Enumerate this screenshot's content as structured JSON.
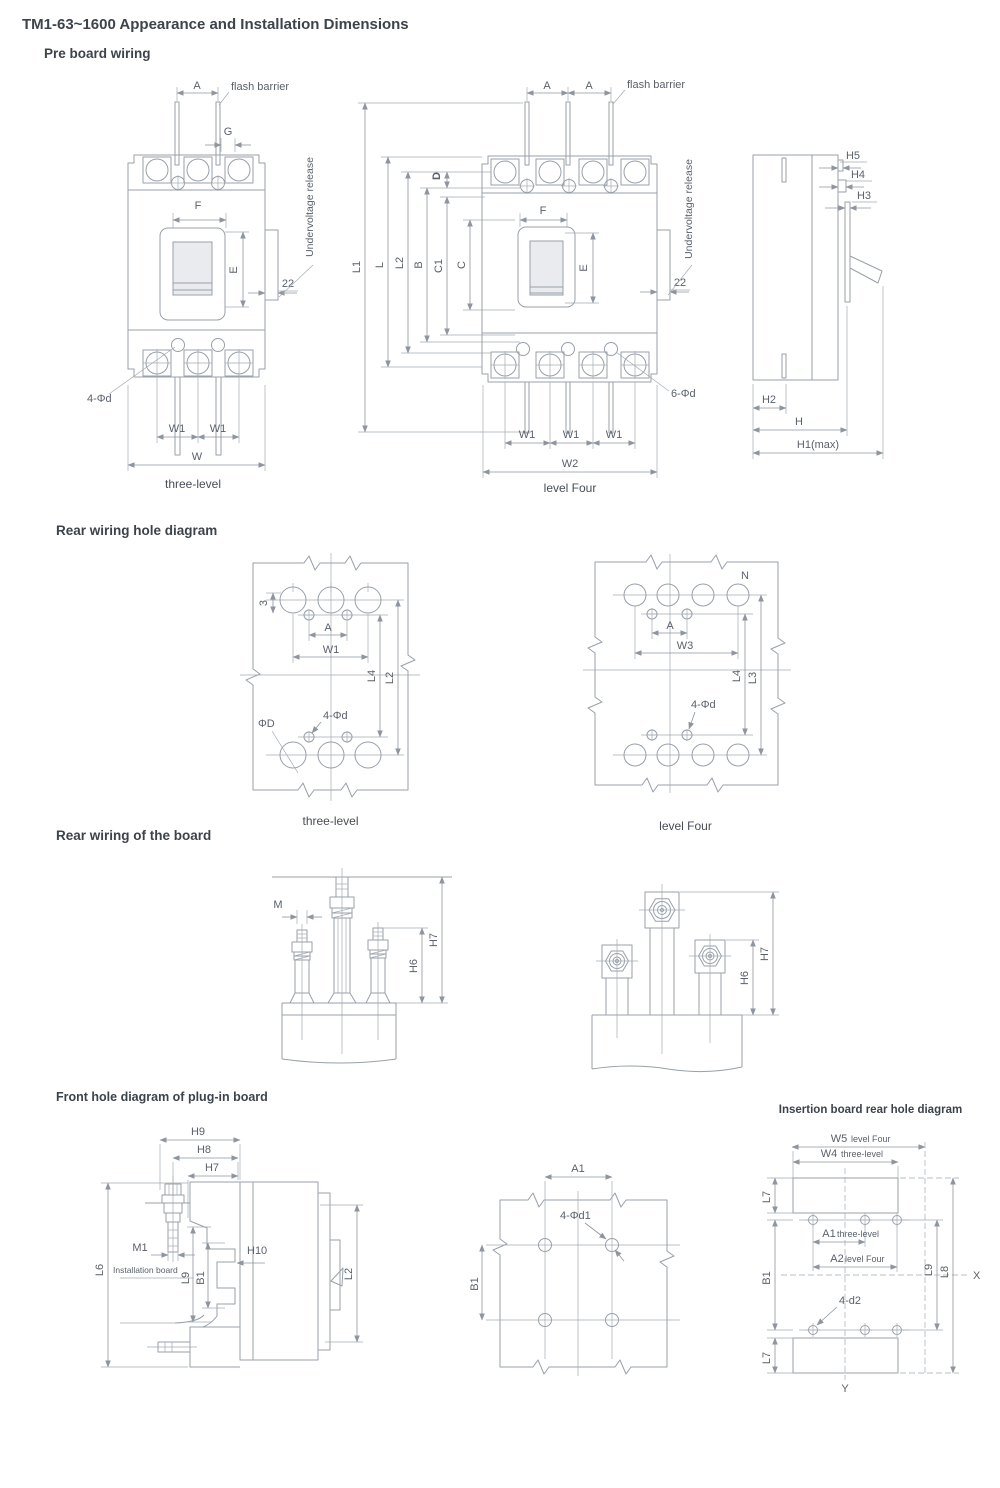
{
  "page": {
    "title": "TM1-63~1600 Appearance and Installation Dimensions"
  },
  "pre": {
    "heading": "Pre board wiring",
    "l3": {
      "a": "A",
      "flash": "flash barrier",
      "g": "G",
      "f": "F",
      "e": "E",
      "uv": "Undervoltage release",
      "n22": "22",
      "holes": "4-Φd",
      "w1": "W1",
      "w": "W",
      "caption": "three-level"
    },
    "l4": {
      "a": "A",
      "flash": "flash barrier",
      "d": "D",
      "l1": "L1",
      "l": "L",
      "l2": "L2",
      "b": "B",
      "c1": "C1",
      "c": "C",
      "f": "F",
      "e": "E",
      "uv": "Undervoltage release",
      "n22": "22",
      "holes": "6-Φd",
      "w1": "W1",
      "w2": "W2",
      "caption": "level Four"
    },
    "side": {
      "h5": "H5",
      "h4": "H4",
      "h3": "H3",
      "h2": "H2",
      "h": "H",
      "h1": "H1(max)"
    }
  },
  "rear_hole": {
    "heading": "Rear wiring hole diagram",
    "l3": {
      "n3": "3",
      "a": "A",
      "w1": "W1",
      "l4": "L4",
      "l2": "L2",
      "phiD": "ΦD",
      "holes": "4-Φd",
      "caption": "three-level"
    },
    "l4": {
      "n": "N",
      "a": "A",
      "w3": "W3",
      "l4": "L4",
      "l3": "L3",
      "holes": "4-Φd",
      "caption": "level Four"
    }
  },
  "rear_board": {
    "heading": "Rear wiring of the board",
    "studs": {
      "m": "M",
      "h6": "H6",
      "h7": "H7"
    },
    "bars": {
      "h6": "H6",
      "h7": "H7"
    }
  },
  "plug": {
    "heading": "Front hole diagram of plug-in board",
    "side": {
      "h9": "H9",
      "h8": "H8",
      "h7": "H7",
      "m1": "M1",
      "board": "Installation board",
      "l9": "L9",
      "b1": "B1",
      "h10": "H10",
      "l6": "L6",
      "l2": "L2"
    },
    "holes": {
      "a1": "A1",
      "holes": "4-Φd1",
      "b1": "B1"
    },
    "insert": {
      "heading": "Insertion board rear hole diagram",
      "w5": "W5",
      "w5n": "level Four",
      "w4": "W4",
      "w4n": "three-level",
      "l7": "L7",
      "b1": "B1",
      "a1": "A1",
      "a1n": "three-level",
      "a2": "A2",
      "a2n": "level Four",
      "holes": "4-d2",
      "l9": "L9",
      "l8": "L8",
      "x": "X",
      "y": "Y"
    }
  }
}
